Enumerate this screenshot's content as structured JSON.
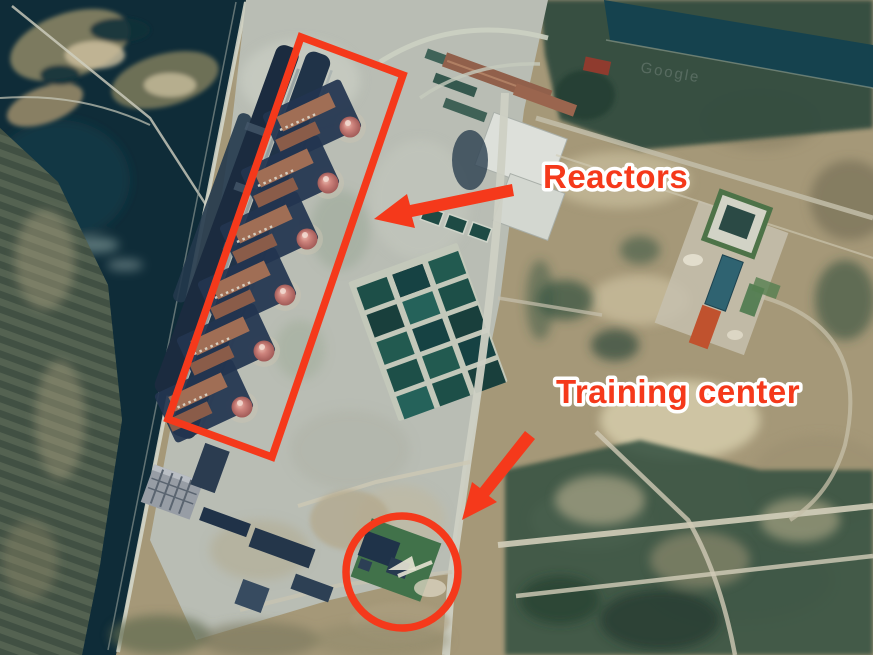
{
  "image": {
    "kind": "annotated satellite photo",
    "subject": "riverside nuclear power plant complex with cooling channel"
  },
  "watermark": "Google",
  "annotations": {
    "accent_color": "#f5391b",
    "label_outline_color": "#ffffff",
    "reactors": {
      "label": "Reactors",
      "marker_shape": "rotated-rectangle-outline",
      "arrow_direction": "down-left"
    },
    "training_center": {
      "label": "Training center",
      "marker_shape": "circle-outline",
      "arrow_direction": "down-left"
    }
  },
  "counts": {
    "reactor_domes": 6
  },
  "scene_palette": {
    "water": "#0f2c38",
    "terrain_tan": "#a59878",
    "vegetation": "#2e4a3c",
    "concrete": "#b9bdb4",
    "reactor_dome": "#cd837c",
    "turbine_hall_roof": "#a06e55"
  }
}
